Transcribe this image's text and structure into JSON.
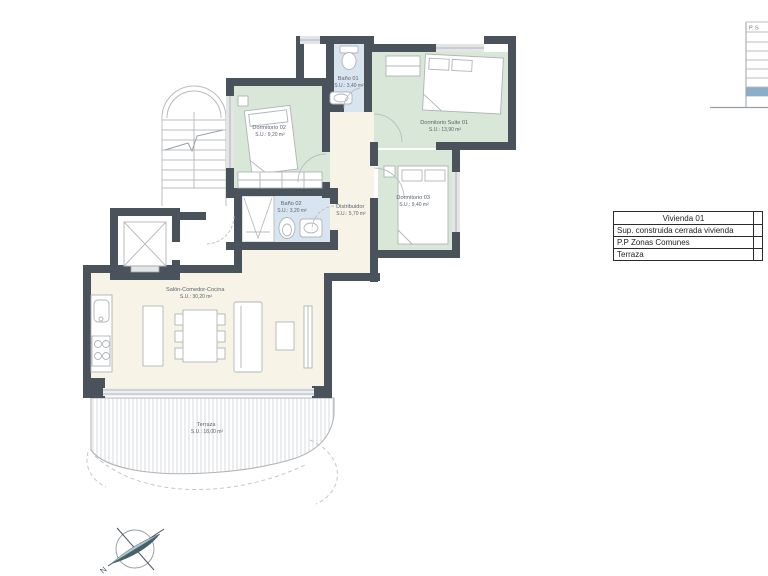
{
  "plan": {
    "rooms": [
      {
        "id": "dormitorio-02",
        "name": "Dormitorio 02",
        "area": "S.U.: 9,20 m²"
      },
      {
        "id": "bano-01",
        "name": "Baño 01",
        "area": "S.U.: 3,40 m²"
      },
      {
        "id": "dormitorio-suite-01",
        "name": "Dormitorio Suite 01",
        "area": "S.U.: 13,90 m²"
      },
      {
        "id": "bano-02",
        "name": "Baño 02",
        "area": "S.U.: 3,20 m²"
      },
      {
        "id": "distribuidor",
        "name": "Distribuidor",
        "area": "S.U.: 5,70 m²"
      },
      {
        "id": "dormitorio-03",
        "name": "Dormitorio 03",
        "area": "S.U.: 9,40 m²"
      },
      {
        "id": "salon-comedor-cocina",
        "name": "Salón-Comedor-Cocina",
        "area": "S.U.: 30,20 m²"
      },
      {
        "id": "terraza",
        "name": "Terraza",
        "area": "S.U.: 18,00 m²"
      }
    ],
    "compass": {
      "north_label": "N"
    }
  },
  "summary_table": {
    "header": "Vivienda 01",
    "rows": [
      {
        "label": "Sup. construida cerrada vivienda"
      },
      {
        "label": "P.P Zonas Comunes"
      },
      {
        "label": "Terraza"
      }
    ]
  },
  "level_strip": {
    "header": "P. S"
  },
  "colors": {
    "wall": "#4a525c",
    "bedroom_fill": "#d8e7d7",
    "bath_fill": "#d8e4ef",
    "interior_fill": "#f7f3e6",
    "highlight_row": "#8badc9",
    "drawing_line": "#b8bcc0"
  }
}
